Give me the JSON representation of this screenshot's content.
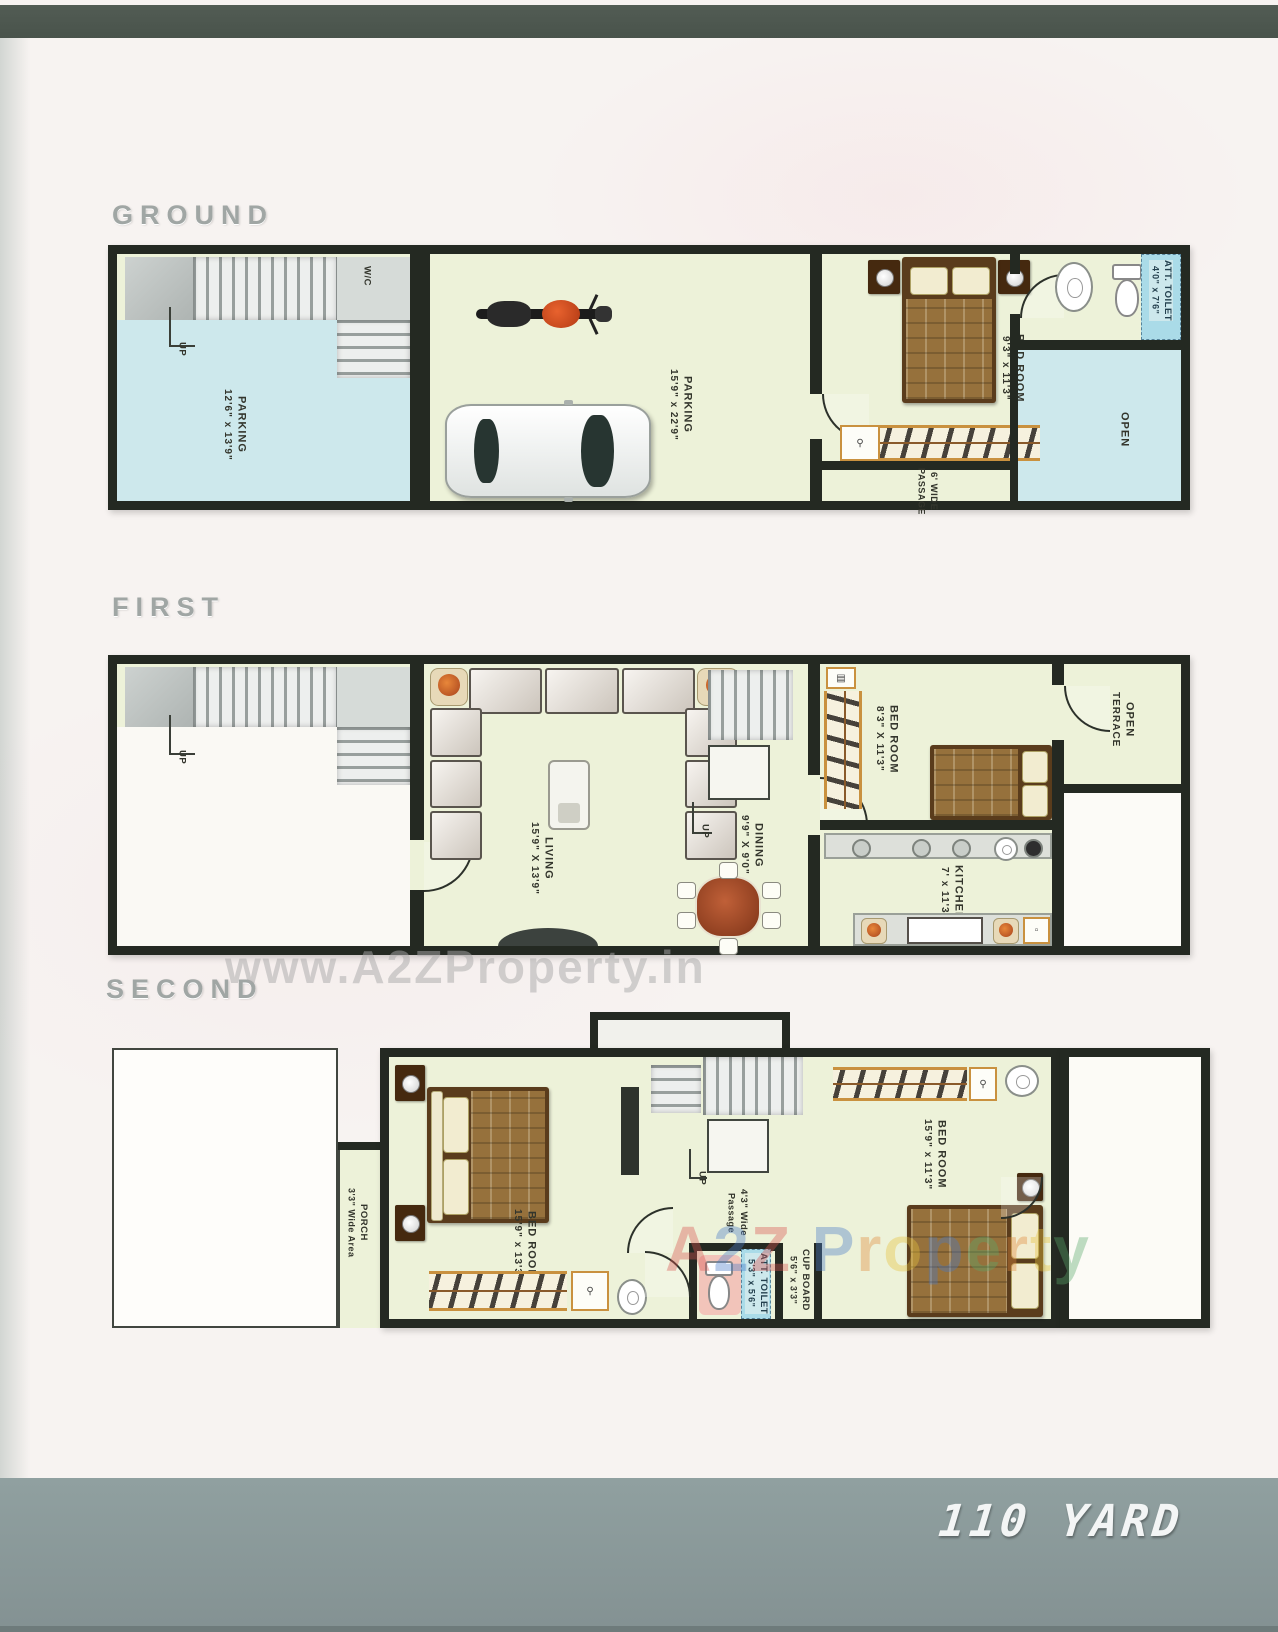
{
  "floors": {
    "ground": {
      "title": "GROUND",
      "wc": "W/C",
      "up": "UP",
      "parking_left": {
        "name": "PARKING",
        "size": "12'6\" x 13'9\""
      },
      "parking_main": {
        "name": "PARKING",
        "size": "15'9\" x 22'9\""
      },
      "bedroom": {
        "name": "BED ROOM",
        "size": "9'3\" x 11'3\""
      },
      "toilet": {
        "name": "ATT. TOILET",
        "size": "4'0\" x 7'6\""
      },
      "open": "OPEN",
      "passage": {
        "name": "6' WIDE",
        "size": "PASSAGE"
      }
    },
    "first": {
      "title": "FIRST",
      "up_stairs": "UP",
      "up_mid": "UP",
      "living": {
        "name": "LIVING",
        "size": "15'9\" X 13'9\""
      },
      "dining": {
        "name": "DINING",
        "size": "9'9\" X 9'0\""
      },
      "bedroom": {
        "name": "BED ROOM",
        "size": "8'3\" X 11'3\""
      },
      "kitchen": {
        "name": "KITCHEN",
        "size": "7' x 11'3\""
      },
      "terrace": {
        "name": "OPEN",
        "size": "TERRACE"
      }
    },
    "second": {
      "title": "SECOND",
      "up": "UP",
      "porch": {
        "name": "PORCH",
        "size": "3'3\" Wide Area"
      },
      "bedroom_left": {
        "name": "BED ROOM",
        "size": "15'9\" x 13'3\""
      },
      "passage": {
        "name": "4'3\" Wide",
        "size": "Passage"
      },
      "toilet": {
        "name": "ATT. TOILET",
        "size": "5'3\" x 5'6\""
      },
      "cupboard": {
        "name": "CUP BOARD",
        "size": "5'6\" x 3'3\""
      },
      "bedroom_right": {
        "name": "BED ROOM",
        "size": "15'9\" x 11'3\""
      }
    }
  },
  "watermarks": {
    "center": "www.A2ZProperty.in",
    "bottom": "A2Z Property",
    "bottom_colors": [
      "#d9534f",
      "#4a7bc9",
      "#d9534f",
      "",
      "#4a7bc9",
      "#e08a3c",
      "#e6c23c",
      "#4a7bc9",
      "#5aa86a",
      "#e08a3c",
      "#e6c23c",
      "#5aa86a"
    ]
  },
  "footer": {
    "area_label": "110 YARD"
  },
  "colors": {
    "wall": "#242922",
    "floor_green": "#edf2d9",
    "floor_blue": "#cde8ec",
    "top_bar": "#4d574f",
    "footer_bar": "#8a9899"
  }
}
